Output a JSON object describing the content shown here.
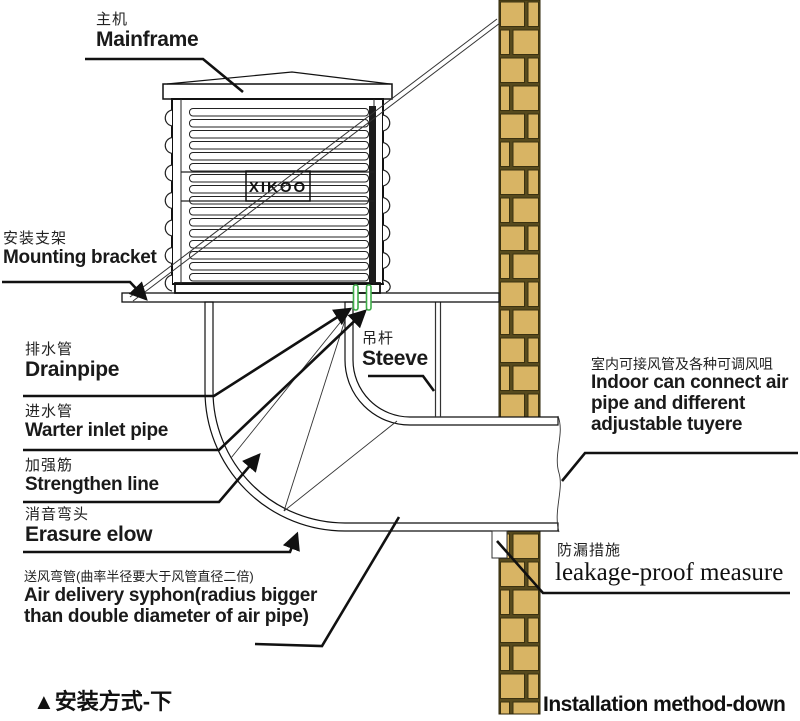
{
  "colors": {
    "brick": "#d8b464",
    "mortar": "#574a1e",
    "pipe_green": "#3fae49",
    "line": "#111111"
  },
  "unit": {
    "logo": "XIKOO"
  },
  "labels": {
    "mainframe": {
      "cn": "主机",
      "en": "Mainframe"
    },
    "mounting_bracket": {
      "cn": "安装支架",
      "en": "Mounting bracket"
    },
    "drainpipe": {
      "cn": "排水管",
      "en": "Drainpipe"
    },
    "water_inlet": {
      "cn": "进水管",
      "en": "Warter inlet pipe"
    },
    "strengthen_line": {
      "cn": "加强筋",
      "en": "Strengthen line"
    },
    "erasure_elbow": {
      "cn": "消音弯头",
      "en": "Erasure elow"
    },
    "air_delivery": {
      "cn": "送风弯管(曲率半径要大于风管直径二倍)",
      "en_line1": "Air delivery syphon(radius bigger",
      "en_line2": "than double diameter of air pipe)"
    },
    "steeve": {
      "cn": "吊杆",
      "en": "Steeve"
    },
    "indoor": {
      "cn": "室内可接风管及各种可调风咀",
      "en_line1": "Indoor can connect air",
      "en_line2": "pipe and different",
      "en_line3": "adjustable tuyere"
    },
    "leakage": {
      "cn": "防漏措施",
      "en": "leakage-proof measure"
    }
  },
  "captions": {
    "marker": "▲",
    "left_text": "安装方式-下",
    "right": "Installation method-down"
  }
}
